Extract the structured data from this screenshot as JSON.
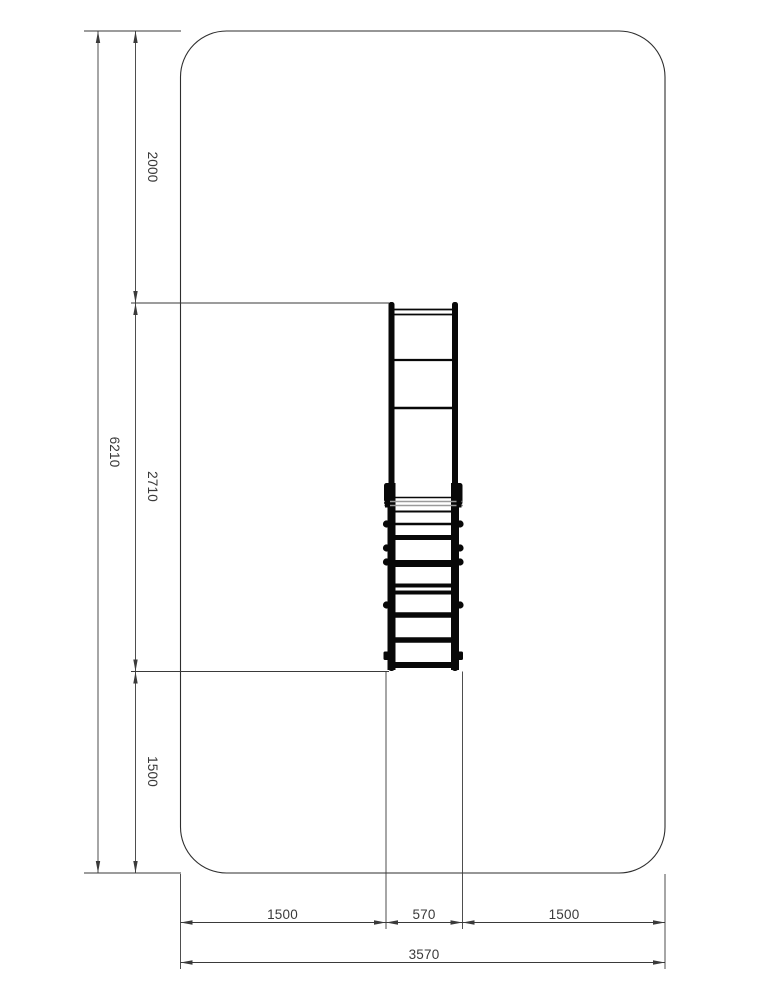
{
  "dimensions": {
    "vertical": {
      "overall_height": "6210",
      "top_clearance": "2000",
      "equipment_length": "2710",
      "bottom_clearance": "1500"
    },
    "horizontal": {
      "left_clearance": "1500",
      "equipment_width": "570",
      "right_clearance": "1500",
      "overall_width": "3570"
    }
  },
  "colors": {
    "background": "#ffffff",
    "dimension_lines": "#3a3a3a",
    "safety_zone_outline": "#2e2e2e",
    "equipment": "#080808",
    "equipment_grey_detail": "#9a9a9a"
  }
}
